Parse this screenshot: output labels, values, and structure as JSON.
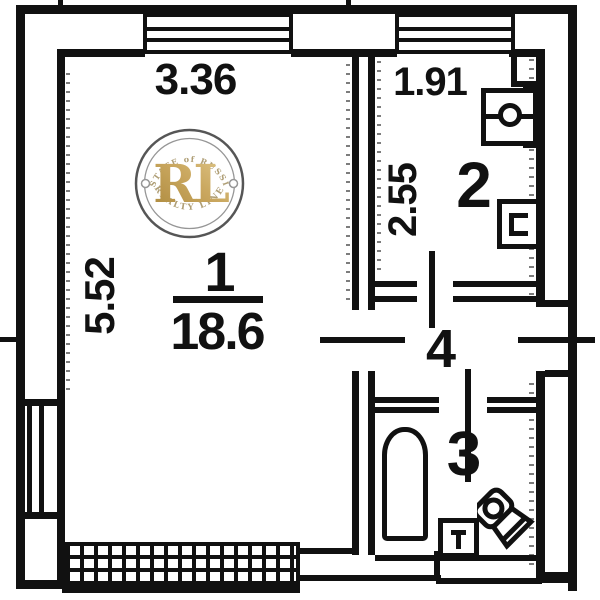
{
  "plan_type": "apartment-floor-plan",
  "colors": {
    "ink": "#111111",
    "paper": "#ffffff",
    "gold_dark": "#a57f2e",
    "gold_mid": "#c7a254",
    "gold_light": "#e0c685",
    "ring_outer": "#4a4a4a",
    "arc_text": "#a9976b"
  },
  "rooms": {
    "room1": {
      "number": "1",
      "area": "18.6",
      "width": "3.36",
      "depth": "5.52"
    },
    "room2": {
      "number": "2",
      "width": "1.91",
      "depth": "2.55"
    },
    "room3": {
      "number": "3"
    },
    "room4": {
      "number": "4"
    }
  },
  "watermark": {
    "arc_top": "ESTATE of RUSSIA",
    "monogram": "RL",
    "arc_bottom": "REALTY LINE"
  },
  "fixtures": {
    "kitchen": [
      "stove",
      "sink"
    ],
    "bathroom": [
      "bathtub",
      "washbasin",
      "toilet"
    ]
  }
}
